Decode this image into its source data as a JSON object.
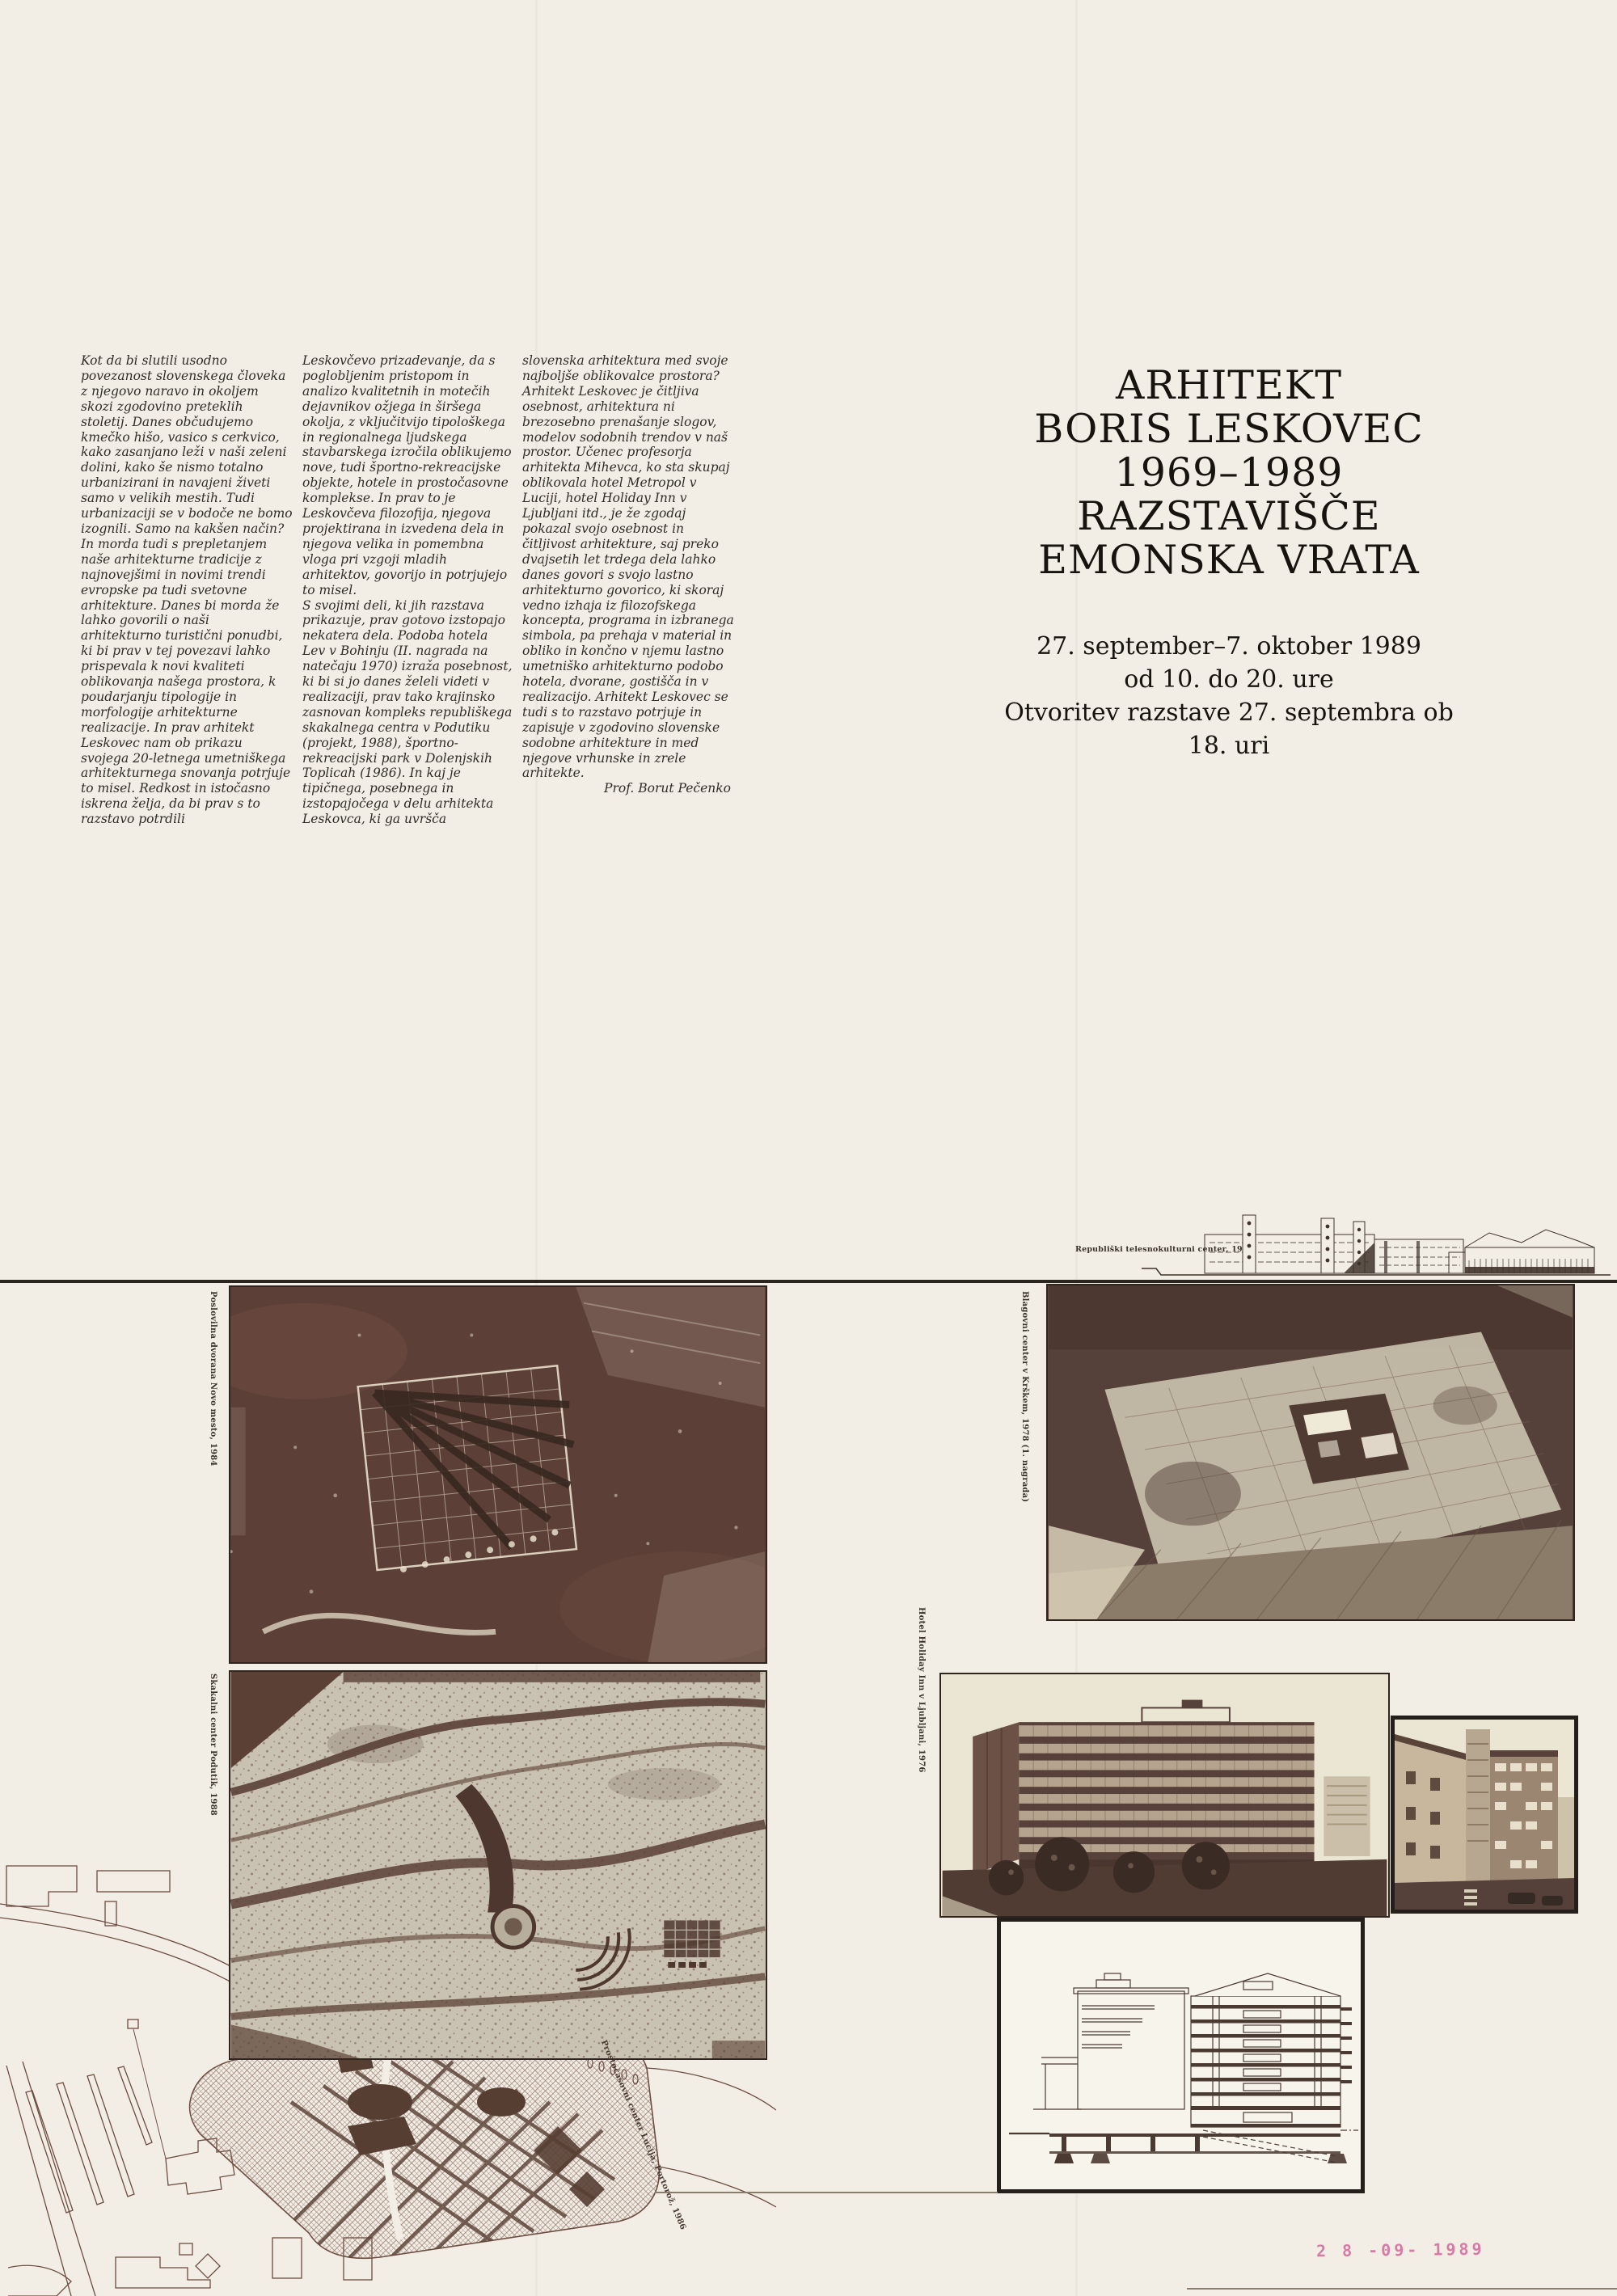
{
  "poster": {
    "colors": {
      "paper": "#f2eee5",
      "ink": "#2f2c28",
      "sepia": "#5e4138",
      "stamp_pink": "#d2679c"
    },
    "essay": {
      "column1": "Kot da bi slutili usodno povezanost slovenskega človeka z njegovo naravo in okoljem skozi zgodovino preteklih stoletij. Danes občudujemo kmečko hišo, vasico s cerkvico, kako zasanjano leži v naši zeleni dolini, kako še nismo totalno urbanizirani in navajeni živeti samo v velikih mestih. Tudi urbanizaciji se v bodoče ne bomo izognili. Samo na kakšen način? In morda tudi s prepletanjem naše arhitekturne tradicije z najnovejšimi in novimi trendi evropske pa tudi svetovne arhitekture. Danes bi morda že lahko govorili o naši arhitekturno turistični ponudbi, ki bi prav v tej povezavi lahko prispevala k novi kvaliteti oblikovanja našega prostora, k poudarjanju tipologije in morfologije arhitekturne realizacije. In prav arhitekt Leskovec nam ob prikazu svojega 20-letnega umetniškega arhitekturnega snovanja potrjuje to misel. Redkost in istočasno iskrena želja, da bi prav s to razstavo potrdili",
      "column2_paragraph1": "Leskovčevo prizadevanje, da s poglobljenim pristopom in analizo kvalitetnih in motečih dejavnikov ožjega in širšega okolja, z vključitvijo tipološkega in regionalnega ljudskega stavbarskega izročila oblikujemo nove, tudi športno-rekreacijske objekte, hotele in prostočasovne komplekse. In prav to je Leskovčeva filozofija, njegova projektirana in izvedena dela in njegova velika in pomembna vloga pri vzgoji mladih arhitektov, govorijo in potrjujejo to misel.",
      "column2_paragraph2": "S svojimi deli, ki jih razstava prikazuje, prav gotovo izstopajo nekatera dela. Podoba hotela Lev v Bohinju (II. nagrada na natečaju 1970) izraža posebnost, ki bi si jo danes želeli videti v realizaciji, prav tako krajinsko zasnovan kompleks republiškega skakalnega centra v Podutiku (projekt, 1988), športno-rekreacijski park v Dolenjskih Toplicah (1986). In kaj je tipičnega, posebnega in izstopajočega v delu arhitekta Leskovca, ki ga uvršča",
      "column3": "slovenska arhitektura med svoje najboljše oblikovalce prostora? Arhitekt Leskovec je čitljiva osebnost, arhitektura ni brezosebno prenašanje slogov, modelov sodobnih trendov v naš prostor. Učenec profesorja arhitekta Mihevca, ko sta skupaj oblikovala hotel Metropol v Luciji, hotel Holiday Inn v Ljubljani itd., je že zgodaj pokazal svojo osebnost in čitljivost arhitekture, saj preko dvajsetih let trdega dela lahko danes govori s svojo lastno arhitekturno govorico, ki skoraj vedno izhaja iz filozofskega koncepta, programa in izbranega simbola, pa prehaja v material in obliko in končno v njemu lastno umetniško arhitekturno podobo hotela, dvorane, gostišča in v realizacijo. Arhitekt Leskovec se tudi s to razstavo potrjuje in zapisuje v zgodovino slovenske sodobne arhitekture in med njegove vrhunske in zrele arhitekte.",
      "signature": "Prof. Borut Pečenko"
    },
    "title_block": {
      "lines": [
        "ARHITEKT",
        "BORIS LESKOVEC",
        "1969–1989",
        "RAZSTAVIŠČE",
        "EMONSKA VRATA"
      ]
    },
    "schedule_block": {
      "lines": [
        "27. september–7. oktober 1989",
        "od 10. do 20. ure",
        "Otvoritev razstave 27. septembra ob",
        "18. uri"
      ]
    },
    "captions": {
      "elevation": "Republiški telesnokulturni center, 1980",
      "photo_top_left": "Poslovilna dvorana Novo mesto, 1984",
      "photo_middle_left": "Skakalni center Podutik, 1988",
      "photo_top_right": "Blagovni center v Krškem, 1978 (1. nagrada)",
      "photo_hotel": "Hotel Holiday Inn v Ljubljani, 1976",
      "site_plan": "Prostočasovni center Lucija, Portorož, 1986"
    },
    "date_stamp": "2 8 -09- 1989"
  }
}
